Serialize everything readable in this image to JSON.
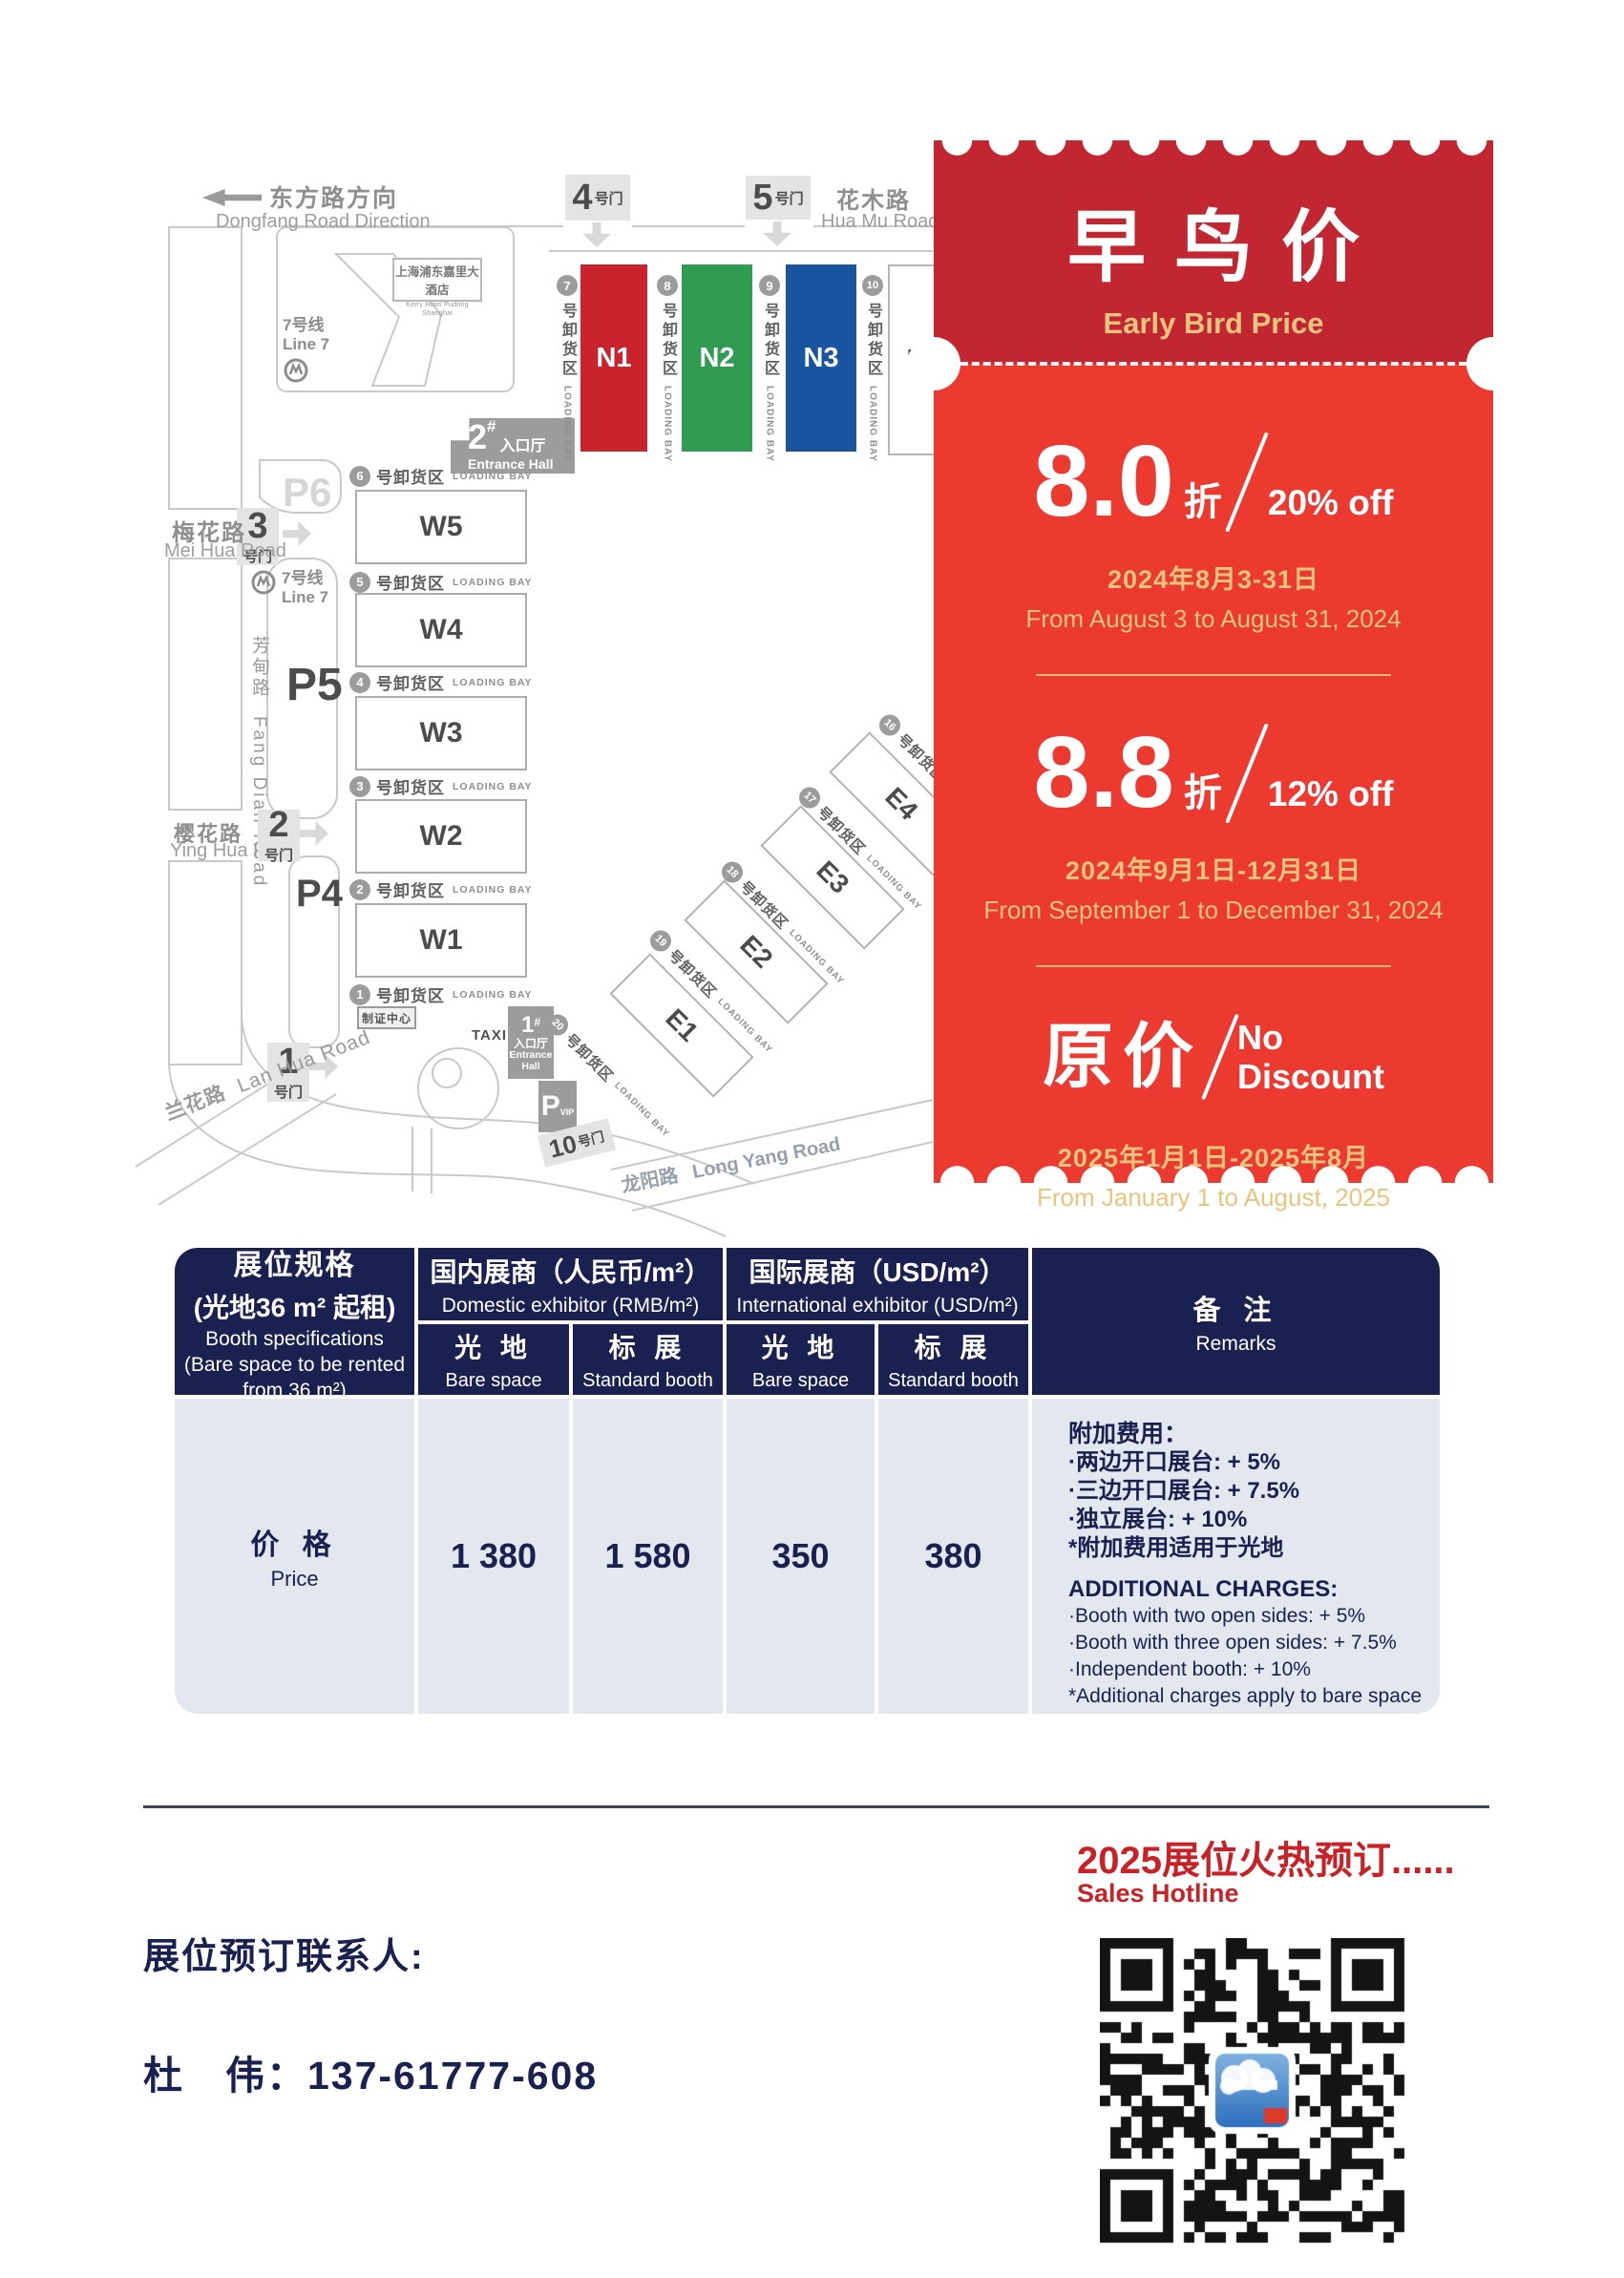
{
  "map": {
    "direction": {
      "cn": "东方路方向",
      "en": "Dongfang Road Direction"
    },
    "roads": {
      "hua_mu": {
        "cn": "花木路",
        "en": "Hua Mu Road"
      },
      "mei_hua": {
        "cn": "梅花路",
        "en": "Mei Hua Road"
      },
      "ying_hua": {
        "cn": "樱花路",
        "en": "Ying Hua Road"
      },
      "lan_hua": {
        "cn": "兰花路",
        "en": "Lan Hua Road"
      },
      "fang_dian": {
        "cn": "芳甸路",
        "en": "Fang Dian Road"
      },
      "long_yang": {
        "cn": "龙阳路",
        "en": "Long Yang Road"
      }
    },
    "metro": {
      "line_cn": "7号线",
      "line_en": "Line 7"
    },
    "hotel": {
      "cn": "上海浦东嘉里大酒店",
      "en": "Kerry Hotel Pudong Shanghai"
    },
    "gates": {
      "g1": {
        "num": "1",
        "suffix": "号门"
      },
      "g2": {
        "num": "2",
        "suffix": "号门"
      },
      "g3": {
        "num": "3",
        "suffix": "号门"
      },
      "g4": {
        "num": "4",
        "suffix": "号门"
      },
      "g5": {
        "num": "5",
        "suffix": "号门"
      },
      "g10": {
        "num": "10",
        "suffix": "号门"
      }
    },
    "parking": {
      "p4": "P4",
      "p5": "P5",
      "p6": "P6",
      "vip_p": "P",
      "vip": "VIP"
    },
    "entrance2": {
      "num": "2",
      "hash": "#",
      "cn": "入口厅",
      "en": "Entrance Hall"
    },
    "entrance1": {
      "num": "1",
      "hash": "#",
      "cn": "入口厅",
      "en1": "Entrance",
      "en2": "Hall"
    },
    "badge_center": "制证中心",
    "taxi": "TAXI",
    "bay_cn": "号卸货区",
    "bay_en": "LOADING BAY",
    "north_halls": [
      "N1",
      "N2",
      "N3",
      "N4"
    ],
    "west_halls": [
      "W5",
      "W4",
      "W3",
      "W2",
      "W1"
    ],
    "east_halls": [
      "E1",
      "E2",
      "E3",
      "E4"
    ],
    "north_bays": [
      "7",
      "8",
      "9",
      "10"
    ],
    "west_bays": [
      "6",
      "5",
      "4",
      "3",
      "2",
      "1"
    ],
    "east_bays": [
      "16",
      "17",
      "18",
      "19",
      "20"
    ]
  },
  "ticket": {
    "title": "早鸟价",
    "subtitle": "Early Bird Price",
    "tiers": [
      {
        "value": "8.0",
        "unit": "折",
        "discount": "20% off",
        "date_cn": "2024年8月3-31日",
        "date_en": "From August 3 to August 31, 2024"
      },
      {
        "value": "8.8",
        "unit": "折",
        "discount": "12% off",
        "date_cn": "2024年9月1日-12月31日",
        "date_en": "From September 1 to December 31, 2024"
      },
      {
        "value": "原价",
        "discount_line1": "No",
        "discount_line2": "Discount",
        "date_cn": "2025年1月1日-2025年8月",
        "date_en": "From January 1 to August, 2025"
      }
    ]
  },
  "table": {
    "spec": {
      "cn1": "展位规格",
      "cn2": "(光地36 m² 起租)",
      "en1": "Booth specifications",
      "en2": "(Bare space to be rented",
      "en3": "from 36 m²)"
    },
    "domestic": {
      "cn": "国内展商（人民币/m²）",
      "en": "Domestic exhibitor (RMB/m²)"
    },
    "international": {
      "cn": "国际展商（USD/m²）",
      "en": "International exhibitor (USD/m²)"
    },
    "bare": {
      "cn": "光 地",
      "en": "Bare space"
    },
    "standard": {
      "cn": "标 展",
      "en": "Standard booth"
    },
    "remarks_header": {
      "cn": "备 注",
      "en": "Remarks"
    },
    "row": {
      "label_cn": "价 格",
      "label_en": "Price",
      "values": [
        "1 380",
        "1 580",
        "350",
        "380"
      ]
    },
    "remarks": {
      "cn_title": "附加费用：",
      "cn_items": [
        "·两边开口展台: + 5%",
        "·三边开口展台: + 7.5%",
        "·独立展台: + 10%"
      ],
      "cn_note": "*附加费用适用于光地",
      "en_title": "ADDITIONAL CHARGES:",
      "en_items": [
        "·Booth with two open sides: + 5%",
        "·Booth with three open sides: + 7.5%",
        "·Independent booth: + 10%"
      ],
      "en_note": "*Additional charges apply to bare space"
    }
  },
  "footer": {
    "hotline_cn": "2025展位火热预订......",
    "hotline_en": "Sales Hotline",
    "contact_heading": "展位预订联系人:",
    "contact_line": "杜　伟：137-61777-608"
  },
  "colors": {
    "ticket_dark_red": "#C22731",
    "ticket_red": "#EC3A31",
    "gold": "#E8C57E",
    "gold_line": "#D9B97C",
    "navy": "#1A2150",
    "table_body": "#E3E7EE",
    "hall_red": "#C9242D",
    "hall_green": "#2F9C52",
    "hall_blue": "#19549F",
    "hotline_red": "#C82227",
    "divider_dark": "#3E4456"
  }
}
